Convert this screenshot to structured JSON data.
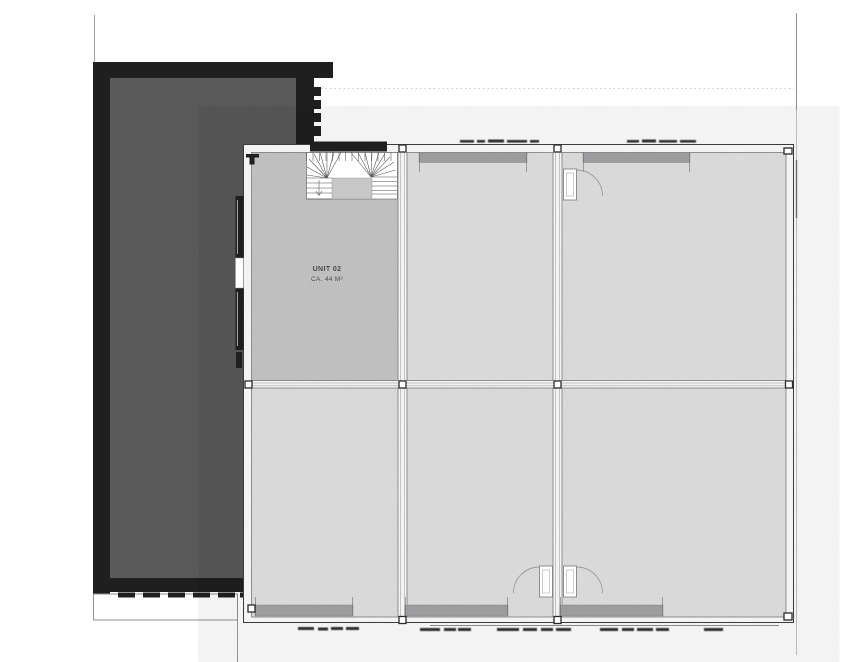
{
  "plan": {
    "unit": {
      "label": "UNIT 02",
      "area": "CA. 44 M²"
    }
  },
  "colors": {
    "background": "#ffffff",
    "building_outline": "#1f1f1f",
    "building_fill": "#595959",
    "room_fill": "#e4e4e5",
    "unit_room_fill": "#c9c9ca",
    "landing_fill": "#c7c7c8",
    "window_bar": "#9c9c9e",
    "wall_line": "#3f3f3f",
    "detail_line": "#9a9a9a",
    "text_color": "#4b4b4b"
  }
}
